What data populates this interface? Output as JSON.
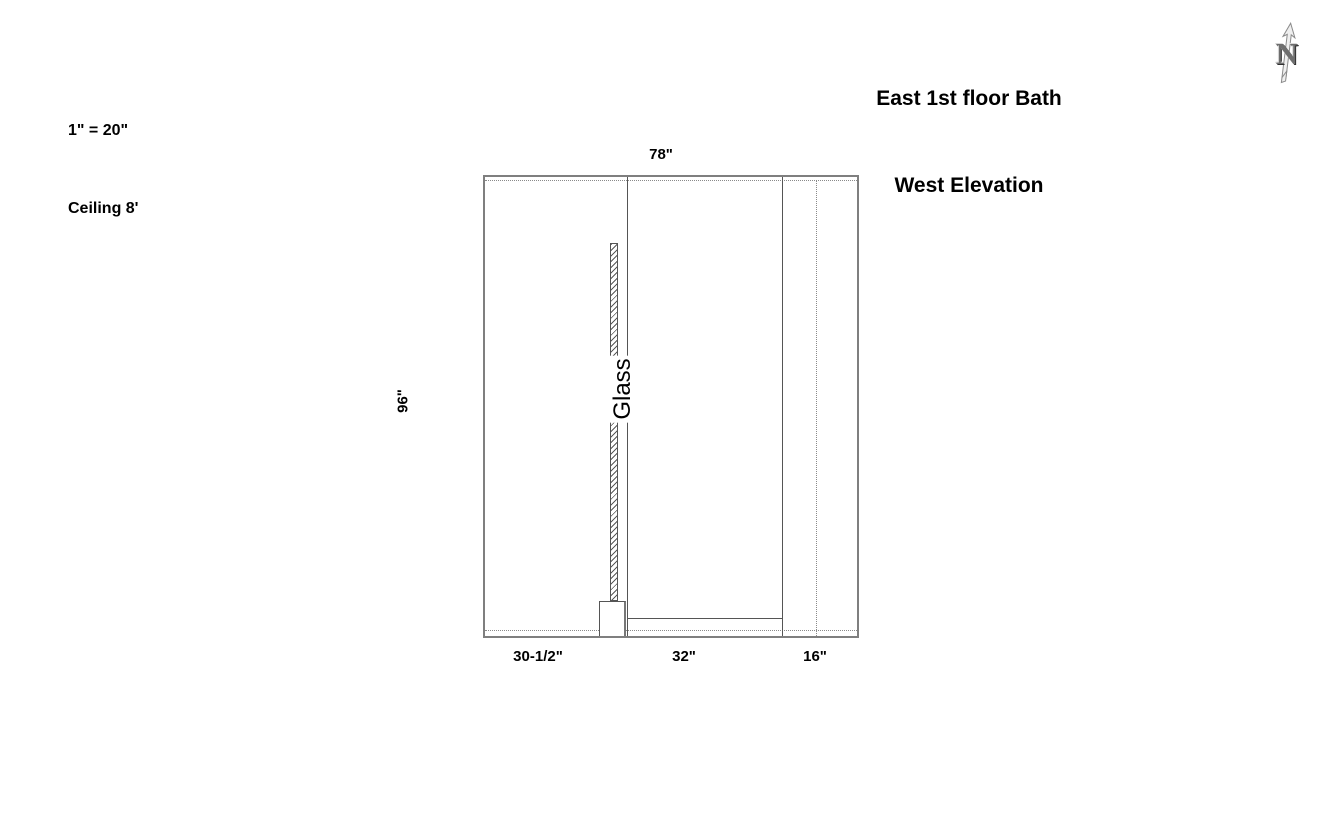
{
  "scale_block": {
    "scale": "1\" = 20\"",
    "ceiling": "Ceiling 8'"
  },
  "title_block": {
    "line1": "East 1st floor Bath",
    "line2": "West Elevation"
  },
  "north_arrow": {
    "letter": "N"
  },
  "drawing": {
    "glass_label": "Glass",
    "dimensions": {
      "overall_width": "78\"",
      "overall_height": "96\"",
      "left_segment": "30-1/2\"",
      "middle_segment": "32\"",
      "right_segment": "16\""
    },
    "colors": {
      "wall_outline": "#7f7f7f",
      "partition_line": "#555555",
      "hidden_line": "#8a8a8a",
      "glass_hatch": "#5a5a5a",
      "text": "#000000",
      "background": "#ffffff"
    }
  }
}
